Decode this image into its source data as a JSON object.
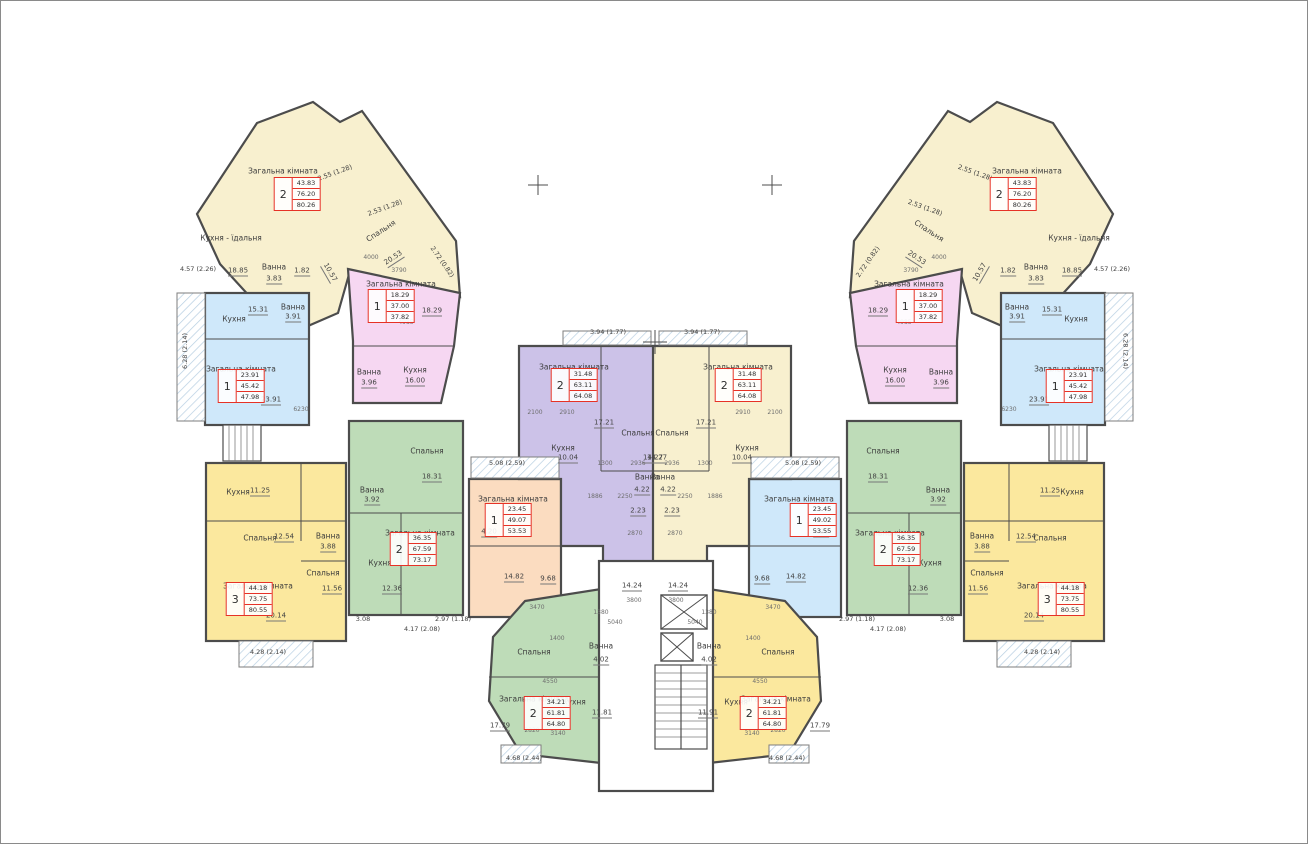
{
  "colors": {
    "cream": "#f8f0cf",
    "pink": "#f6d7f2",
    "blue": "#cfe8fa",
    "green": "#bedcb8",
    "yellow": "#fbe89e",
    "purple": "#ccc2e8",
    "peach": "#fbdcc0",
    "wall": "#4c4c4c",
    "red": "#e63226",
    "hatch": "#b7cfe2",
    "white": "#ffffff"
  },
  "apartments": [
    {
      "name": "2-room top-left",
      "rooms": "2",
      "areas": [
        "43.83",
        "76.20",
        "80.26"
      ],
      "x": 296,
      "y": 193
    },
    {
      "name": "1-room pink left",
      "rooms": "1",
      "areas": [
        "18.29",
        "37.00",
        "37.82"
      ],
      "x": 390,
      "y": 305
    },
    {
      "name": "1-room blue top-left",
      "rooms": "1",
      "areas": [
        "23.91",
        "45.42",
        "47.98"
      ],
      "x": 240,
      "y": 385
    },
    {
      "name": "2-room green left",
      "rooms": "2",
      "areas": [
        "36.35",
        "67.59",
        "73.17"
      ],
      "x": 412,
      "y": 548
    },
    {
      "name": "3-room yellow left",
      "rooms": "3",
      "areas": [
        "44.18",
        "73.75",
        "80.55"
      ],
      "x": 248,
      "y": 598
    },
    {
      "name": "1-room peach center-left",
      "rooms": "1",
      "areas": [
        "23.45",
        "49.07",
        "53.53"
      ],
      "x": 507,
      "y": 519
    },
    {
      "name": "2-room purple center-left",
      "rooms": "2",
      "areas": [
        "31.48",
        "63.11",
        "64.08"
      ],
      "x": 573,
      "y": 384
    },
    {
      "name": "2-room cream center-right",
      "rooms": "2",
      "areas": [
        "31.48",
        "63.11",
        "64.08"
      ],
      "x": 737,
      "y": 384
    },
    {
      "name": "1-room blue center-right",
      "rooms": "1",
      "areas": [
        "23.45",
        "49.02",
        "53.55"
      ],
      "x": 812,
      "y": 519
    },
    {
      "name": "2-room green right",
      "rooms": "2",
      "areas": [
        "36.35",
        "67.59",
        "73.17"
      ],
      "x": 896,
      "y": 548
    },
    {
      "name": "3-room yellow right",
      "rooms": "3",
      "areas": [
        "44.18",
        "73.75",
        "80.55"
      ],
      "x": 1060,
      "y": 598
    },
    {
      "name": "1-room pink right",
      "rooms": "1",
      "areas": [
        "18.29",
        "37.00",
        "37.82"
      ],
      "x": 918,
      "y": 305
    },
    {
      "name": "1-room blue top-right",
      "rooms": "1",
      "areas": [
        "23.91",
        "45.42",
        "47.98"
      ],
      "x": 1068,
      "y": 385
    },
    {
      "name": "2-room top-right",
      "rooms": "2",
      "areas": [
        "43.83",
        "76.20",
        "80.26"
      ],
      "x": 1012,
      "y": 193
    },
    {
      "name": "2-room green bottom",
      "rooms": "2",
      "areas": [
        "34.21",
        "61.81",
        "64.80"
      ],
      "x": 546,
      "y": 712
    },
    {
      "name": "2-room yellow bottom",
      "rooms": "2",
      "areas": [
        "34.21",
        "61.81",
        "64.80"
      ],
      "x": 762,
      "y": 712
    }
  ],
  "labels": [
    {
      "t": "Загальна кімната",
      "x": 282,
      "y": 170
    },
    {
      "t": "Спальня",
      "x": 380,
      "y": 230,
      "r": -33
    },
    {
      "t": "20.53",
      "x": 393,
      "y": 258,
      "c": "area",
      "r": -33
    },
    {
      "t": "Кухня - їдальня",
      "x": 230,
      "y": 237
    },
    {
      "t": "18.85",
      "x": 237,
      "y": 271,
      "c": "area"
    },
    {
      "t": "Ванна",
      "x": 273,
      "y": 266
    },
    {
      "t": "3.83",
      "x": 273,
      "y": 279,
      "c": "area"
    },
    {
      "t": "1.82",
      "x": 301,
      "y": 271,
      "c": "area"
    },
    {
      "t": "10.57",
      "x": 328,
      "y": 272,
      "c": "area",
      "r": 60
    },
    {
      "t": "Загальна кімната",
      "x": 400,
      "y": 283
    },
    {
      "t": "18.29",
      "x": 431,
      "y": 311,
      "c": "area"
    },
    {
      "t": "Ванна",
      "x": 368,
      "y": 371
    },
    {
      "t": "3.96",
      "x": 368,
      "y": 383,
      "c": "area"
    },
    {
      "t": "Кухня",
      "x": 414,
      "y": 369
    },
    {
      "t": "16.00",
      "x": 414,
      "y": 381,
      "c": "area"
    },
    {
      "t": "Кухня",
      "x": 233,
      "y": 318
    },
    {
      "t": "15.31",
      "x": 257,
      "y": 310,
      "c": "area"
    },
    {
      "t": "Загальна кімната",
      "x": 240,
      "y": 368
    },
    {
      "t": "23.91",
      "x": 270,
      "y": 400,
      "c": "area"
    },
    {
      "t": "Ванна",
      "x": 292,
      "y": 306
    },
    {
      "t": "3.91",
      "x": 292,
      "y": 317,
      "c": "area"
    },
    {
      "t": "Спальня",
      "x": 426,
      "y": 450
    },
    {
      "t": "18.31",
      "x": 431,
      "y": 477,
      "c": "area"
    },
    {
      "t": "Ванна",
      "x": 371,
      "y": 489
    },
    {
      "t": "3.92",
      "x": 371,
      "y": 500,
      "c": "area"
    },
    {
      "t": "Загальна кімната",
      "x": 419,
      "y": 532
    },
    {
      "t": "Кухня",
      "x": 379,
      "y": 562
    },
    {
      "t": "12.36",
      "x": 391,
      "y": 589,
      "c": "area"
    },
    {
      "t": "Кухня",
      "x": 237,
      "y": 491
    },
    {
      "t": "11.25",
      "x": 259,
      "y": 491,
      "c": "area"
    },
    {
      "t": "Спальня",
      "x": 259,
      "y": 537
    },
    {
      "t": "12.54",
      "x": 283,
      "y": 537,
      "c": "area"
    },
    {
      "t": "Ванна",
      "x": 327,
      "y": 535
    },
    {
      "t": "3.88",
      "x": 327,
      "y": 547,
      "c": "area"
    },
    {
      "t": "Загальна кімната",
      "x": 257,
      "y": 585
    },
    {
      "t": "20.14",
      "x": 275,
      "y": 616,
      "c": "area"
    },
    {
      "t": "Спальня",
      "x": 322,
      "y": 572
    },
    {
      "t": "11.56",
      "x": 331,
      "y": 589,
      "c": "area"
    },
    {
      "t": "Загальна кімната",
      "x": 512,
      "y": 498
    },
    {
      "t": "4.20",
      "x": 488,
      "y": 532,
      "c": "area"
    },
    {
      "t": "14.82",
      "x": 513,
      "y": 577,
      "c": "area"
    },
    {
      "t": "9.68",
      "x": 547,
      "y": 579,
      "c": "area"
    },
    {
      "t": "Загальна кімната",
      "x": 573,
      "y": 366
    },
    {
      "t": "Спальня",
      "x": 637,
      "y": 432
    },
    {
      "t": "17.21",
      "x": 603,
      "y": 423,
      "c": "area"
    },
    {
      "t": "Кухня",
      "x": 562,
      "y": 447
    },
    {
      "t": "10.04",
      "x": 567,
      "y": 458,
      "c": "area"
    },
    {
      "t": "Ванна",
      "x": 646,
      "y": 476
    },
    {
      "t": "4.22",
      "x": 641,
      "y": 490,
      "c": "area"
    },
    {
      "t": "14.27",
      "x": 652,
      "y": 458,
      "c": "area"
    },
    {
      "t": "2.23",
      "x": 637,
      "y": 511,
      "c": "area"
    },
    {
      "t": "14.24",
      "x": 631,
      "y": 586,
      "c": "area"
    },
    {
      "t": "Загальна кімната",
      "x": 737,
      "y": 366
    },
    {
      "t": "Спальня",
      "x": 671,
      "y": 432
    },
    {
      "t": "17.21",
      "x": 705,
      "y": 423,
      "c": "area"
    },
    {
      "t": "Кухня",
      "x": 746,
      "y": 447
    },
    {
      "t": "10.04",
      "x": 741,
      "y": 458,
      "c": "area"
    },
    {
      "t": "Ванна",
      "x": 662,
      "y": 476
    },
    {
      "t": "4.22",
      "x": 667,
      "y": 490,
      "c": "area"
    },
    {
      "t": "14.27",
      "x": 656,
      "y": 458,
      "c": "area"
    },
    {
      "t": "2.23",
      "x": 671,
      "y": 511,
      "c": "area"
    },
    {
      "t": "14.24",
      "x": 677,
      "y": 586,
      "c": "area"
    },
    {
      "t": "Загальна кімната",
      "x": 798,
      "y": 498
    },
    {
      "t": "4.20",
      "x": 820,
      "y": 532,
      "c": "area"
    },
    {
      "t": "14.82",
      "x": 795,
      "y": 577,
      "c": "area"
    },
    {
      "t": "9.68",
      "x": 761,
      "y": 579,
      "c": "area"
    },
    {
      "t": "Спальня",
      "x": 882,
      "y": 450
    },
    {
      "t": "18.31",
      "x": 877,
      "y": 477,
      "c": "area"
    },
    {
      "t": "Ванна",
      "x": 937,
      "y": 489
    },
    {
      "t": "3.92",
      "x": 937,
      "y": 500,
      "c": "area"
    },
    {
      "t": "Загальна кімната",
      "x": 889,
      "y": 532
    },
    {
      "t": "Кухня",
      "x": 929,
      "y": 562
    },
    {
      "t": "12.36",
      "x": 917,
      "y": 589,
      "c": "area"
    },
    {
      "t": "Кухня",
      "x": 1071,
      "y": 491
    },
    {
      "t": "11.25",
      "x": 1049,
      "y": 491,
      "c": "area"
    },
    {
      "t": "Спальня",
      "x": 1049,
      "y": 537
    },
    {
      "t": "12.54",
      "x": 1025,
      "y": 537,
      "c": "area"
    },
    {
      "t": "Ванна",
      "x": 981,
      "y": 535
    },
    {
      "t": "3.88",
      "x": 981,
      "y": 547,
      "c": "area"
    },
    {
      "t": "Загальна кімната",
      "x": 1051,
      "y": 585
    },
    {
      "t": "20.14",
      "x": 1033,
      "y": 616,
      "c": "area"
    },
    {
      "t": "Спальня",
      "x": 986,
      "y": 572
    },
    {
      "t": "11.56",
      "x": 977,
      "y": 589,
      "c": "area"
    },
    {
      "t": "Загальна кімната",
      "x": 908,
      "y": 283
    },
    {
      "t": "18.29",
      "x": 877,
      "y": 311,
      "c": "area"
    },
    {
      "t": "Ванна",
      "x": 940,
      "y": 371
    },
    {
      "t": "3.96",
      "x": 940,
      "y": 383,
      "c": "area"
    },
    {
      "t": "Кухня",
      "x": 894,
      "y": 369
    },
    {
      "t": "16.00",
      "x": 894,
      "y": 381,
      "c": "area"
    },
    {
      "t": "Кухня",
      "x": 1075,
      "y": 318
    },
    {
      "t": "15.31",
      "x": 1051,
      "y": 310,
      "c": "area"
    },
    {
      "t": "Загальна кімната",
      "x": 1068,
      "y": 368
    },
    {
      "t": "23.91",
      "x": 1038,
      "y": 400,
      "c": "area"
    },
    {
      "t": "Ванна",
      "x": 1016,
      "y": 306
    },
    {
      "t": "3.91",
      "x": 1016,
      "y": 317,
      "c": "area"
    },
    {
      "t": "Загальна кімната",
      "x": 1026,
      "y": 170
    },
    {
      "t": "Спальня",
      "x": 928,
      "y": 230,
      "r": 33
    },
    {
      "t": "20.53",
      "x": 915,
      "y": 258,
      "c": "area",
      "r": 33
    },
    {
      "t": "Кухня - їдальня",
      "x": 1078,
      "y": 237
    },
    {
      "t": "18.85",
      "x": 1071,
      "y": 271,
      "c": "area"
    },
    {
      "t": "Ванна",
      "x": 1035,
      "y": 266
    },
    {
      "t": "3.83",
      "x": 1035,
      "y": 279,
      "c": "area"
    },
    {
      "t": "1.82",
      "x": 1007,
      "y": 271,
      "c": "area"
    },
    {
      "t": "10.57",
      "x": 980,
      "y": 272,
      "c": "area",
      "r": -60
    },
    {
      "t": "Спальня",
      "x": 533,
      "y": 651
    },
    {
      "t": "Ванна",
      "x": 600,
      "y": 645
    },
    {
      "t": "4.02",
      "x": 600,
      "y": 660,
      "c": "area"
    },
    {
      "t": "Кухня",
      "x": 573,
      "y": 701
    },
    {
      "t": "11.81",
      "x": 601,
      "y": 713,
      "c": "area"
    },
    {
      "t": "Загальна кімната",
      "x": 533,
      "y": 698
    },
    {
      "t": "17.79",
      "x": 499,
      "y": 726,
      "c": "area"
    },
    {
      "t": "Спальня",
      "x": 777,
      "y": 651
    },
    {
      "t": "Ванна",
      "x": 708,
      "y": 645
    },
    {
      "t": "4.02",
      "x": 708,
      "y": 660,
      "c": "area"
    },
    {
      "t": "Кухня",
      "x": 735,
      "y": 701
    },
    {
      "t": "11.91",
      "x": 707,
      "y": 713,
      "c": "area"
    },
    {
      "t": "Загальна кімната",
      "x": 775,
      "y": 698
    },
    {
      "t": "17.79",
      "x": 819,
      "y": 726,
      "c": "area"
    },
    {
      "t": "2.55 (1.28)",
      "x": 334,
      "y": 172,
      "c": "dim",
      "r": -20
    },
    {
      "t": "2.53 (1.28)",
      "x": 384,
      "y": 207,
      "c": "dim",
      "r": -20
    },
    {
      "t": "2.72 (0.82)",
      "x": 441,
      "y": 261,
      "c": "dim",
      "r": 55
    },
    {
      "t": "4.57 (2.26)",
      "x": 197,
      "y": 268,
      "c": "dim"
    },
    {
      "t": "6.28 (2.14)",
      "x": 184,
      "y": 350,
      "c": "dim",
      "r": -90
    },
    {
      "t": "4.28 (2.14)",
      "x": 267,
      "y": 651,
      "c": "dim"
    },
    {
      "t": "5.08 (2.59)",
      "x": 506,
      "y": 462,
      "c": "dim"
    },
    {
      "t": "3.94 (1.77)",
      "x": 607,
      "y": 331,
      "c": "dim"
    },
    {
      "t": "3.94 (1.77)",
      "x": 701,
      "y": 331,
      "c": "dim"
    },
    {
      "t": "3.08",
      "x": 362,
      "y": 618,
      "c": "dim"
    },
    {
      "t": "4.17 (2.08)",
      "x": 421,
      "y": 628,
      "c": "dim"
    },
    {
      "t": "2.97 (1.18)",
      "x": 452,
      "y": 618,
      "c": "dim"
    },
    {
      "t": "4.68 (2.44)",
      "x": 523,
      "y": 757,
      "c": "dim"
    },
    {
      "t": "4.68 (2.44)",
      "x": 786,
      "y": 757,
      "c": "dim"
    },
    {
      "t": "2.55 (1.28)",
      "x": 974,
      "y": 172,
      "c": "dim",
      "r": 20
    },
    {
      "t": "2.53 (1.28)",
      "x": 924,
      "y": 207,
      "c": "dim",
      "r": 20
    },
    {
      "t": "2.72 (0.82)",
      "x": 867,
      "y": 261,
      "c": "dim",
      "r": -55
    },
    {
      "t": "4.57 (2.26)",
      "x": 1111,
      "y": 268,
      "c": "dim"
    },
    {
      "t": "6.28 (2.14)",
      "x": 1124,
      "y": 350,
      "c": "dim",
      "r": 90
    },
    {
      "t": "4.28 (2.14)",
      "x": 1041,
      "y": 651,
      "c": "dim"
    },
    {
      "t": "5.08 (2.59)",
      "x": 802,
      "y": 462,
      "c": "dim"
    },
    {
      "t": "2.97 (1.18)",
      "x": 856,
      "y": 618,
      "c": "dim"
    },
    {
      "t": "4.17 (2.08)",
      "x": 887,
      "y": 628,
      "c": "dim"
    },
    {
      "t": "3.08",
      "x": 946,
      "y": 618,
      "c": "dim"
    },
    {
      "t": "3790",
      "x": 398,
      "y": 270,
      "c": "dimnum"
    },
    {
      "t": "3790",
      "x": 910,
      "y": 270,
      "c": "dimnum"
    },
    {
      "t": "4985",
      "x": 405,
      "y": 322,
      "c": "dimnum"
    },
    {
      "t": "4985",
      "x": 903,
      "y": 322,
      "c": "dimnum"
    },
    {
      "t": "4000",
      "x": 370,
      "y": 257,
      "c": "dimnum"
    },
    {
      "t": "4000",
      "x": 938,
      "y": 257,
      "c": "dimnum"
    },
    {
      "t": "2100",
      "x": 534,
      "y": 412,
      "c": "dimnum"
    },
    {
      "t": "2910",
      "x": 566,
      "y": 412,
      "c": "dimnum"
    },
    {
      "t": "2910",
      "x": 742,
      "y": 412,
      "c": "dimnum"
    },
    {
      "t": "2100",
      "x": 774,
      "y": 412,
      "c": "dimnum"
    },
    {
      "t": "2936",
      "x": 637,
      "y": 463,
      "c": "dimnum"
    },
    {
      "t": "2936",
      "x": 671,
      "y": 463,
      "c": "dimnum"
    },
    {
      "t": "1300",
      "x": 604,
      "y": 463,
      "c": "dimnum"
    },
    {
      "t": "1300",
      "x": 704,
      "y": 463,
      "c": "dimnum"
    },
    {
      "t": "1886",
      "x": 594,
      "y": 496,
      "c": "dimnum"
    },
    {
      "t": "1886",
      "x": 714,
      "y": 496,
      "c": "dimnum"
    },
    {
      "t": "2250",
      "x": 624,
      "y": 496,
      "c": "dimnum"
    },
    {
      "t": "2250",
      "x": 684,
      "y": 496,
      "c": "dimnum"
    },
    {
      "t": "2870",
      "x": 634,
      "y": 533,
      "c": "dimnum"
    },
    {
      "t": "2870",
      "x": 674,
      "y": 533,
      "c": "dimnum"
    },
    {
      "t": "3800",
      "x": 633,
      "y": 600,
      "c": "dimnum"
    },
    {
      "t": "3800",
      "x": 675,
      "y": 600,
      "c": "dimnum"
    },
    {
      "t": "3470",
      "x": 536,
      "y": 607,
      "c": "dimnum"
    },
    {
      "t": "3470",
      "x": 772,
      "y": 607,
      "c": "dimnum"
    },
    {
      "t": "1380",
      "x": 600,
      "y": 612,
      "c": "dimnum"
    },
    {
      "t": "1380",
      "x": 708,
      "y": 612,
      "c": "dimnum"
    },
    {
      "t": "5040",
      "x": 614,
      "y": 622,
      "c": "dimnum"
    },
    {
      "t": "5040",
      "x": 694,
      "y": 622,
      "c": "dimnum"
    },
    {
      "t": "1400",
      "x": 556,
      "y": 638,
      "c": "dimnum"
    },
    {
      "t": "1400",
      "x": 752,
      "y": 638,
      "c": "dimnum"
    },
    {
      "t": "4550",
      "x": 549,
      "y": 681,
      "c": "dimnum"
    },
    {
      "t": "4550",
      "x": 759,
      "y": 681,
      "c": "dimnum"
    },
    {
      "t": "3140",
      "x": 557,
      "y": 733,
      "c": "dimnum"
    },
    {
      "t": "3140",
      "x": 751,
      "y": 733,
      "c": "dimnum"
    },
    {
      "t": "2820",
      "x": 531,
      "y": 730,
      "c": "dimnum"
    },
    {
      "t": "2820",
      "x": 777,
      "y": 730,
      "c": "dimnum"
    },
    {
      "t": "6230",
      "x": 300,
      "y": 409,
      "c": "dimnum"
    },
    {
      "t": "6230",
      "x": 1008,
      "y": 409,
      "c": "dimnum"
    }
  ]
}
